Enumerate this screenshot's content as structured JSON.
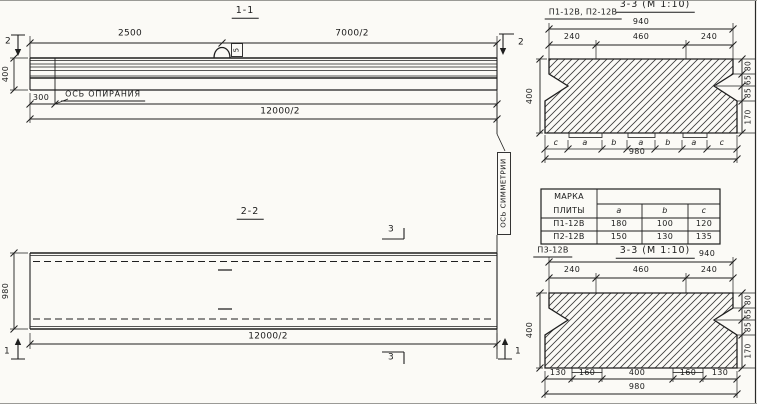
{
  "colors": {
    "ink": "#1b1b1b",
    "paper": "#fbfaf6"
  },
  "s11": {
    "title": "1-1",
    "dim_left_span": "2500",
    "dim_right_span": "7000/2",
    "cut_marker": "2",
    "height": "400",
    "support_offset": "300",
    "support_axis_label": "ОСЬ ОПИРАНИЯ",
    "half_span": "11400/2",
    "total_span": "12000/2",
    "loop_tag": "5"
  },
  "s22": {
    "title": "2-2",
    "cut_marker_3": "3",
    "cut_marker_1": "1",
    "height": "980",
    "total_span": "12000/2"
  },
  "sym_axis_label": "ОСЬ СИММЕТРИИ",
  "s33t": {
    "plate_marks": "П1-12В, П2-12В",
    "title": "3-3 (М 1:10)",
    "width_top": "940",
    "seg": [
      "240",
      "460",
      "240"
    ],
    "height": "400",
    "right": [
      "80",
      "65",
      "85",
      "170"
    ],
    "letters": [
      "c",
      "a",
      "b",
      "a",
      "b",
      "a",
      "c"
    ],
    "width_bottom": "980"
  },
  "tbl": {
    "head_line1": "МАРКА",
    "head_line2": "ПЛИТЫ",
    "group_header": "БУКВЕННОЕ  ВЫРАЖЕНИЕ",
    "cols": [
      "a",
      "b",
      "c"
    ],
    "rows": [
      [
        "П1-12В",
        "180",
        "100",
        "120"
      ],
      [
        "П2-12В",
        "150",
        "130",
        "135"
      ]
    ]
  },
  "s33b": {
    "plate_mark": "П3-12В",
    "title": "3-3 (М 1:10)",
    "width_top": "940",
    "seg": [
      "240",
      "460",
      "240"
    ],
    "height": "400",
    "right": [
      "80",
      "65",
      "85",
      "170"
    ],
    "bottom": [
      "130",
      "160",
      "400",
      "160",
      "130"
    ],
    "width_bottom": "980"
  }
}
